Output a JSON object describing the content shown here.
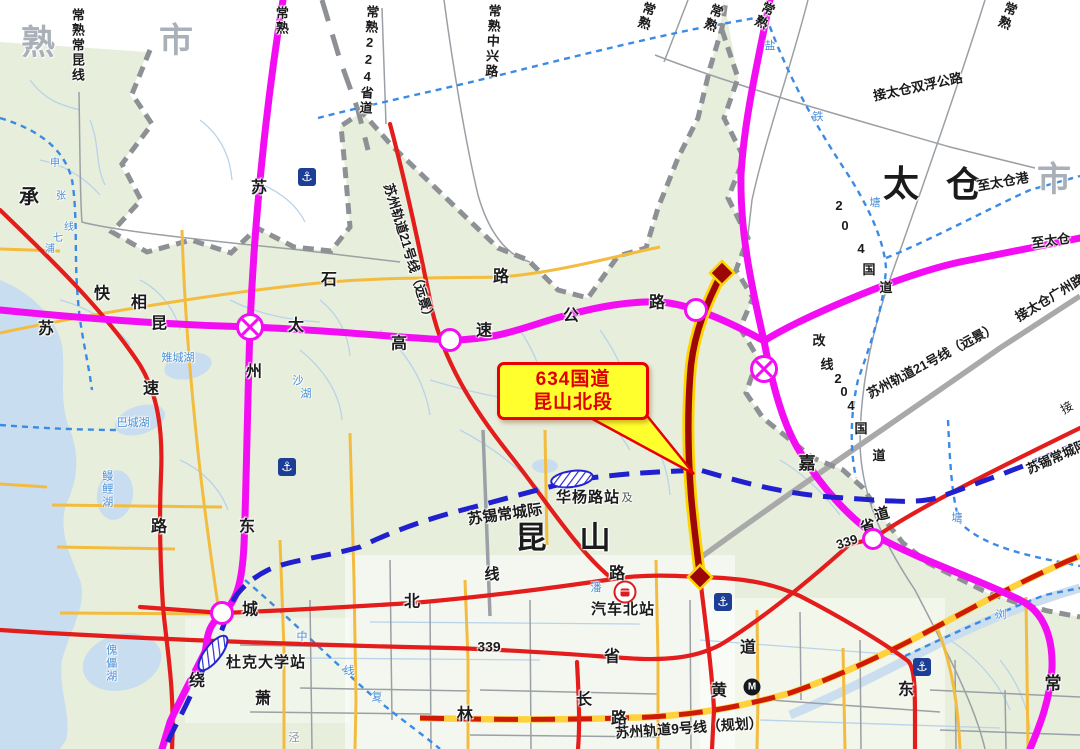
{
  "callout": {
    "line1": "634国道",
    "line2": "昆山北段"
  },
  "map": {
    "highlighted_road": "634国道昆山北段",
    "labels": [
      {
        "t": "熟",
        "x": 38,
        "y": 44,
        "s": 34,
        "c": "#a9b0b8",
        "b": 1,
        "n": "city-label-changshu"
      },
      {
        "t": "市",
        "x": 176,
        "y": 42,
        "s": 34,
        "c": "#a9b0b8",
        "b": 1,
        "n": "city-label-changshu-shi"
      },
      {
        "t": "市",
        "x": 1054,
        "y": 181,
        "s": 34,
        "c": "#a9b0b8",
        "b": 1,
        "n": "city-label-taicang-shi"
      },
      {
        "t": "太",
        "x": 901,
        "y": 184,
        "s": 36,
        "b": 1,
        "n": "city-label-taicang"
      },
      {
        "t": "仓",
        "x": 964,
        "y": 185,
        "s": 36,
        "b": 1,
        "n": "city-label-taicang2"
      },
      {
        "t": "昆",
        "x": 531,
        "y": 539,
        "s": 31,
        "b": 1,
        "n": "city-label-kunshan"
      },
      {
        "t": "山",
        "x": 595,
        "y": 539,
        "s": 31,
        "b": 1,
        "n": "city-label-kunshan2"
      },
      {
        "t": "承",
        "x": 29,
        "y": 198,
        "s": 20,
        "b": 1
      },
      {
        "t": "嘉",
        "x": 807,
        "y": 464,
        "s": 17,
        "b": 1
      },
      {
        "t": "常",
        "x": 1053,
        "y": 684,
        "s": 17,
        "b": 1
      },
      {
        "t": "苏",
        "x": 46,
        "y": 330,
        "s": 16,
        "b": 1
      },
      {
        "t": "快",
        "x": 102,
        "y": 295,
        "s": 16,
        "b": 1
      },
      {
        "t": "相",
        "x": 139,
        "y": 304,
        "s": 16,
        "b": 1
      },
      {
        "t": "昆",
        "x": 159,
        "y": 325,
        "s": 16,
        "b": 1
      },
      {
        "t": "太",
        "x": 296,
        "y": 327,
        "s": 16,
        "b": 1
      },
      {
        "t": "高",
        "x": 399,
        "y": 345,
        "s": 16,
        "b": 1
      },
      {
        "t": "速",
        "x": 484,
        "y": 332,
        "s": 16,
        "b": 1
      },
      {
        "t": "公",
        "x": 571,
        "y": 317,
        "s": 16,
        "b": 1
      },
      {
        "t": "路",
        "x": 657,
        "y": 304,
        "s": 16,
        "b": 1
      },
      {
        "t": "石",
        "x": 329,
        "y": 281,
        "s": 16,
        "b": 1
      },
      {
        "t": "路",
        "x": 501,
        "y": 278,
        "s": 16,
        "b": 1
      },
      {
        "t": "苏",
        "x": 259,
        "y": 189,
        "s": 16,
        "b": 1
      },
      {
        "t": "州",
        "x": 254,
        "y": 373,
        "s": 16,
        "b": 1
      },
      {
        "t": "速",
        "x": 151,
        "y": 390,
        "s": 16,
        "b": 1
      },
      {
        "t": "路",
        "x": 159,
        "y": 528,
        "s": 16,
        "b": 1
      },
      {
        "t": "东",
        "x": 247,
        "y": 528,
        "s": 16,
        "b": 1
      },
      {
        "t": "城",
        "x": 250,
        "y": 611,
        "s": 16,
        "b": 1
      },
      {
        "t": "绕",
        "x": 197,
        "y": 682,
        "s": 16,
        "b": 1
      },
      {
        "t": "北",
        "x": 412,
        "y": 603,
        "s": 16,
        "b": 1
      },
      {
        "t": "线",
        "x": 492,
        "y": 575,
        "s": 15,
        "b": 1
      },
      {
        "t": "路",
        "x": 617,
        "y": 575,
        "s": 16,
        "b": 1
      },
      {
        "t": "东",
        "x": 906,
        "y": 691,
        "s": 16,
        "b": 1
      },
      {
        "t": "黄",
        "x": 719,
        "y": 692,
        "s": 16,
        "b": 1
      },
      {
        "t": "长",
        "x": 584,
        "y": 701,
        "s": 16,
        "b": 1
      },
      {
        "t": "林",
        "x": 465,
        "y": 716,
        "s": 16,
        "b": 1
      },
      {
        "t": "萧",
        "x": 263,
        "y": 700,
        "s": 16,
        "b": 1
      },
      {
        "t": "路",
        "x": 619,
        "y": 720,
        "s": 16,
        "b": 1
      },
      {
        "t": "省",
        "x": 612,
        "y": 658,
        "s": 16,
        "b": 1
      },
      {
        "t": "道",
        "x": 748,
        "y": 649,
        "s": 16,
        "b": 1
      },
      {
        "t": "339",
        "x": 489,
        "y": 647,
        "s": 14,
        "b": 1,
        "n": "road-label-s339"
      },
      {
        "t": "省",
        "x": 868,
        "y": 527,
        "s": 15,
        "b": 1,
        "r": -15
      },
      {
        "t": "道",
        "x": 882,
        "y": 515,
        "s": 15,
        "b": 1,
        "r": -15
      },
      {
        "t": "339",
        "x": 847,
        "y": 542,
        "s": 13,
        "b": 1,
        "r": -18,
        "n": "road-label-s339b"
      },
      {
        "t": "及",
        "x": 627,
        "y": 499,
        "s": 11,
        "c": "#555"
      },
      {
        "t": "汽车北站",
        "x": 623,
        "y": 610,
        "s": 15,
        "b": 1,
        "ls": 1,
        "n": "station-label-qichebeizhan"
      },
      {
        "t": "华杨路站",
        "x": 588,
        "y": 498,
        "s": 15,
        "b": 1,
        "ls": 1,
        "n": "station-label-huayanglu"
      },
      {
        "t": "杜克大学站",
        "x": 266,
        "y": 663,
        "s": 15,
        "b": 1,
        "ls": 1,
        "n": "station-label-duke"
      },
      {
        "t": "苏锡常城际",
        "x": 505,
        "y": 515,
        "s": 15,
        "b": 1,
        "r": -8,
        "n": "line-label-suxichang"
      },
      {
        "t": "苏州轨道9号线（规划）",
        "x": 689,
        "y": 728,
        "s": 14,
        "b": 1,
        "r": -4,
        "n": "line-label-metro9"
      },
      {
        "t": "苏州轨道21号线（远景）",
        "x": 409,
        "y": 253,
        "s": 13,
        "b": 1,
        "r": 73,
        "n": "line-label-metro21-west"
      },
      {
        "t": "苏州轨道21号线（远景）",
        "x": 932,
        "y": 361,
        "s": 13,
        "b": 1,
        "r": -28,
        "n": "line-label-metro21-east"
      },
      {
        "t": "苏锡常城际",
        "x": 1057,
        "y": 457,
        "s": 13,
        "b": 1,
        "r": -24
      },
      {
        "t": "接",
        "x": 1067,
        "y": 408,
        "s": 12,
        "r": -30
      },
      {
        "t": "接太仓双浮公路",
        "x": 918,
        "y": 87,
        "s": 13,
        "b": 1,
        "r": -12
      },
      {
        "t": "至太仓港",
        "x": 1003,
        "y": 182,
        "s": 13,
        "b": 1,
        "r": -10
      },
      {
        "t": "至太仓",
        "x": 1051,
        "y": 241,
        "s": 13,
        "b": 1,
        "r": -8
      },
      {
        "t": "接太仓广州路",
        "x": 1050,
        "y": 298,
        "s": 13,
        "b": 1,
        "r": -31
      },
      {
        "t": "常熟常昆线",
        "x": 77,
        "y": 8,
        "s": 13,
        "b": 1,
        "v": 1
      },
      {
        "t": "常熟",
        "x": 281,
        "y": 6,
        "s": 13,
        "b": 1,
        "v": 1
      },
      {
        "t": "常熟224省道",
        "x": 372,
        "y": 5,
        "s": 13,
        "b": 1,
        "v": 1,
        "r": 4
      },
      {
        "t": "常熟中兴路",
        "x": 494,
        "y": 4,
        "s": 13,
        "b": 1,
        "v": 1,
        "r": 3
      },
      {
        "t": "常熟",
        "x": 650,
        "y": 2,
        "s": 13,
        "b": 1,
        "v": 1,
        "r": 18
      },
      {
        "t": "常熟",
        "x": 718,
        "y": 4,
        "s": 13,
        "b": 1,
        "v": 1,
        "r": 22
      },
      {
        "t": "常熟",
        "x": 770,
        "y": 2,
        "s": 13,
        "b": 1,
        "v": 1,
        "r": 26
      },
      {
        "t": "常熟",
        "x": 1012,
        "y": 2,
        "s": 13,
        "b": 1,
        "v": 1,
        "r": 22
      },
      {
        "t": "2",
        "x": 839,
        "y": 206,
        "s": 13,
        "b": 1
      },
      {
        "t": "0",
        "x": 845,
        "y": 226,
        "s": 13,
        "b": 1
      },
      {
        "t": "4",
        "x": 861,
        "y": 249,
        "s": 13,
        "b": 1
      },
      {
        "t": "国",
        "x": 869,
        "y": 270,
        "s": 13,
        "b": 1
      },
      {
        "t": "道",
        "x": 886,
        "y": 288,
        "s": 13,
        "b": 1
      },
      {
        "t": "改",
        "x": 819,
        "y": 341,
        "s": 13,
        "b": 1
      },
      {
        "t": "线",
        "x": 827,
        "y": 365,
        "s": 13,
        "b": 1
      },
      {
        "t": "2",
        "x": 838,
        "y": 379,
        "s": 13,
        "b": 1
      },
      {
        "t": "0",
        "x": 844,
        "y": 392,
        "s": 13,
        "b": 1
      },
      {
        "t": "4",
        "x": 851,
        "y": 406,
        "s": 13,
        "b": 1
      },
      {
        "t": "国",
        "x": 861,
        "y": 429,
        "s": 13,
        "b": 1
      },
      {
        "t": "道",
        "x": 879,
        "y": 456,
        "s": 13,
        "b": 1
      },
      {
        "t": "盐",
        "x": 770,
        "y": 47,
        "s": 11,
        "c": "#4b8fd4"
      },
      {
        "t": "铁",
        "x": 818,
        "y": 118,
        "s": 11,
        "c": "#4b8fd4"
      },
      {
        "t": "塘",
        "x": 875,
        "y": 204,
        "s": 11,
        "c": "#4b8fd4"
      },
      {
        "t": "塘",
        "x": 957,
        "y": 519,
        "s": 11,
        "c": "#4b8fd4"
      },
      {
        "t": "浏",
        "x": 1001,
        "y": 616,
        "s": 11,
        "c": "#4b8fd4"
      },
      {
        "t": "申",
        "x": 55,
        "y": 164,
        "s": 10,
        "c": "#4b8fd4"
      },
      {
        "t": "张",
        "x": 61,
        "y": 197,
        "s": 10,
        "c": "#4b8fd4"
      },
      {
        "t": "线",
        "x": 69,
        "y": 228,
        "s": 10,
        "c": "#4b8fd4"
      },
      {
        "t": "七",
        "x": 58,
        "y": 239,
        "s": 10,
        "c": "#4b8fd4"
      },
      {
        "t": "浦",
        "x": 50,
        "y": 250,
        "s": 10,
        "c": "#4b8fd4"
      },
      {
        "t": "沙",
        "x": 298,
        "y": 382,
        "s": 11,
        "c": "#4b8fd4"
      },
      {
        "t": "湖",
        "x": 306,
        "y": 395,
        "s": 11,
        "c": "#4b8fd4"
      },
      {
        "t": "中",
        "x": 302,
        "y": 638,
        "s": 11,
        "c": "#4b8fd4"
      },
      {
        "t": "线",
        "x": 349,
        "y": 672,
        "s": 11,
        "c": "#4b8fd4"
      },
      {
        "t": "复",
        "x": 377,
        "y": 698,
        "s": 11,
        "c": "#4b8fd4"
      },
      {
        "t": "潘",
        "x": 596,
        "y": 589,
        "s": 11,
        "c": "#4b8fd4"
      },
      {
        "t": "泾",
        "x": 294,
        "y": 739,
        "s": 11,
        "c": "#8892a0"
      },
      {
        "t": "雉城湖",
        "x": 178,
        "y": 359,
        "s": 11,
        "c": "#4b8fd4"
      },
      {
        "t": "巴城湖",
        "x": 133,
        "y": 424,
        "s": 11,
        "c": "#4b8fd4"
      },
      {
        "t": "鳗鲤湖",
        "x": 106,
        "y": 470,
        "s": 11,
        "c": "#4b8fd4",
        "v": 1
      },
      {
        "t": "傀儡湖",
        "x": 110,
        "y": 644,
        "s": 11,
        "c": "#4b8fd4",
        "v": 1
      }
    ],
    "icons": [
      {
        "type": "anchor",
        "x": 307,
        "y": 177,
        "n": "anchor-icon"
      },
      {
        "type": "anchor",
        "x": 287,
        "y": 467,
        "n": "anchor-icon"
      },
      {
        "type": "anchor",
        "x": 723,
        "y": 602,
        "n": "anchor-icon"
      },
      {
        "type": "anchor",
        "x": 922,
        "y": 667,
        "n": "anchor-icon"
      },
      {
        "type": "bus",
        "x": 625,
        "y": 592,
        "n": "bus-station-icon"
      },
      {
        "type": "metro",
        "x": 752,
        "y": 687,
        "n": "metro-logo-icon"
      },
      {
        "type": "ringx",
        "x": 250,
        "y": 327,
        "r": 11,
        "n": "interchange-icon"
      },
      {
        "type": "ringx",
        "x": 764,
        "y": 341,
        "r": 11,
        "n": "interchange-icon"
      },
      {
        "type": "ring",
        "x": 450,
        "y": 340,
        "r": 9,
        "n": "junction-icon"
      },
      {
        "type": "ring",
        "x": 696,
        "y": 310,
        "r": 9,
        "n": "junction-icon"
      },
      {
        "type": "ring",
        "x": 222,
        "y": 613,
        "r": 9,
        "n": "junction-icon"
      },
      {
        "type": "ring",
        "x": 873,
        "y": 539,
        "r": 8,
        "n": "junction-icon"
      }
    ],
    "colors": {
      "expressway": "#f20df2",
      "road_red": "#e31c1c",
      "road_yellow": "#f3bc3f",
      "intercity_rail": "#2020cf",
      "waterway": "#3b8be6",
      "metro9": "#cf1a0a",
      "highlight_core": "#9c0808",
      "highlight_casing": "#ffd400",
      "callout_bg": "#ffff2e",
      "callout_red": "#e80000"
    }
  }
}
